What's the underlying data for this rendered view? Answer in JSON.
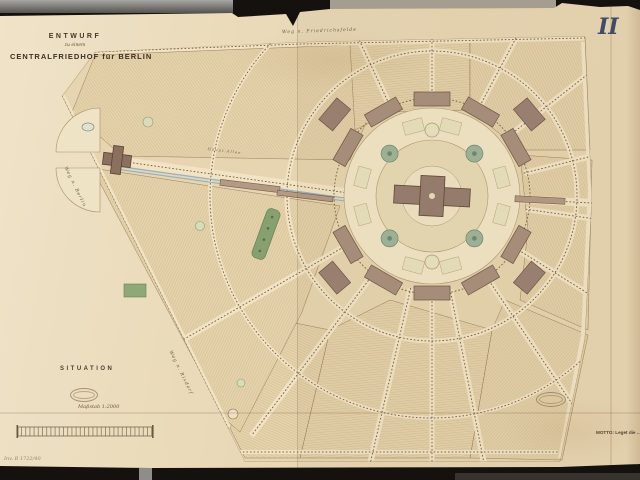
{
  "document": {
    "plate_number": "II",
    "title": {
      "line1": "ENTWURF",
      "line2": "zu einem",
      "line3": "CENTRALFRIEDHOF für BERLIN"
    },
    "situation_label": "SITUATION",
    "scale_caption": "Maßstab 1:2000",
    "motto": "MOTTO: Leget die …",
    "inventory_note": "Inv. B 1722/40",
    "road_labels": {
      "top": "Weg n. Friedrichsfelde",
      "left": "Weg n. Berlin",
      "bottom_left": "Weg n. Rixdorf",
      "main_axis": "Haupt-Allee"
    }
  },
  "colors": {
    "paper": "#e9d8b6",
    "field_tone": "#e4d2ab",
    "hatch_ink": "#a98a5f",
    "road_pale": "#f1e3c4",
    "building_brown": "#a8907e",
    "gate_brown": "#8b7060",
    "garden_green": "#87a070",
    "rosette_green": "#9fb49a",
    "rail_blue": "#8fb0c9",
    "plate_ink": "#3c4b6e"
  }
}
